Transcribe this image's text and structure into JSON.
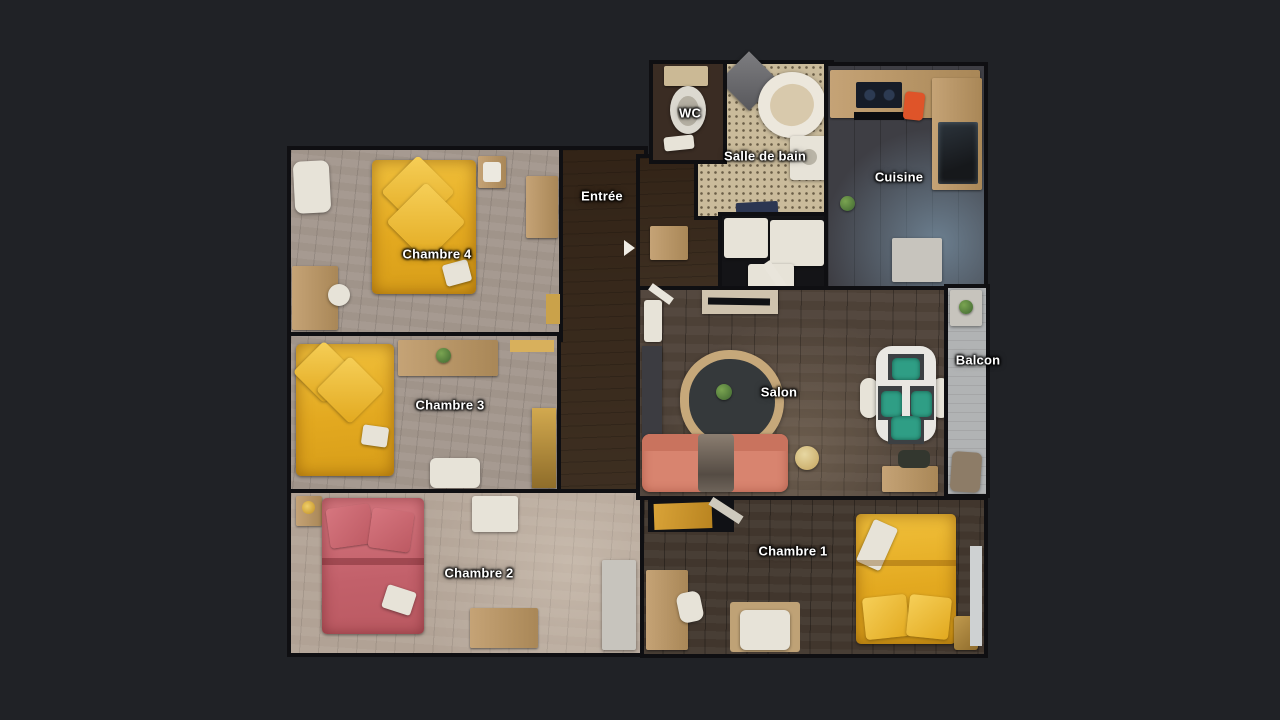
{
  "floorplan": {
    "title": "Apartment floor plan (top-down 3D scan view)",
    "rooms": [
      {
        "id": "wc",
        "label": "WC"
      },
      {
        "id": "salle_de_bain",
        "label": "Salle de bain"
      },
      {
        "id": "cuisine",
        "label": "Cuisine"
      },
      {
        "id": "entree",
        "label": "Entrée"
      },
      {
        "id": "chambre_4",
        "label": "Chambre 4"
      },
      {
        "id": "chambre_3",
        "label": "Chambre 3"
      },
      {
        "id": "chambre_2",
        "label": "Chambre 2"
      },
      {
        "id": "salon",
        "label": "Salon"
      },
      {
        "id": "balcon",
        "label": "Balcon"
      },
      {
        "id": "chambre_1",
        "label": "Chambre 1"
      }
    ],
    "palette": {
      "background": "#202226",
      "wall": "#0f0f12",
      "bed_yellow": "#e9b32d",
      "bed_pink": "#ce6f73",
      "sofa_coral": "#d8846f",
      "chair_teal": "#2f9e85",
      "floor_light_wood": "#a0948a",
      "floor_dark_wood": "#4d4137",
      "floor_entree": "#74624f",
      "bathroom_tile": "#cabb9b",
      "kitchen_floor": "#3e3e44",
      "balcony_gray": "#b1b3b4",
      "label_text": "#ffffff"
    }
  }
}
